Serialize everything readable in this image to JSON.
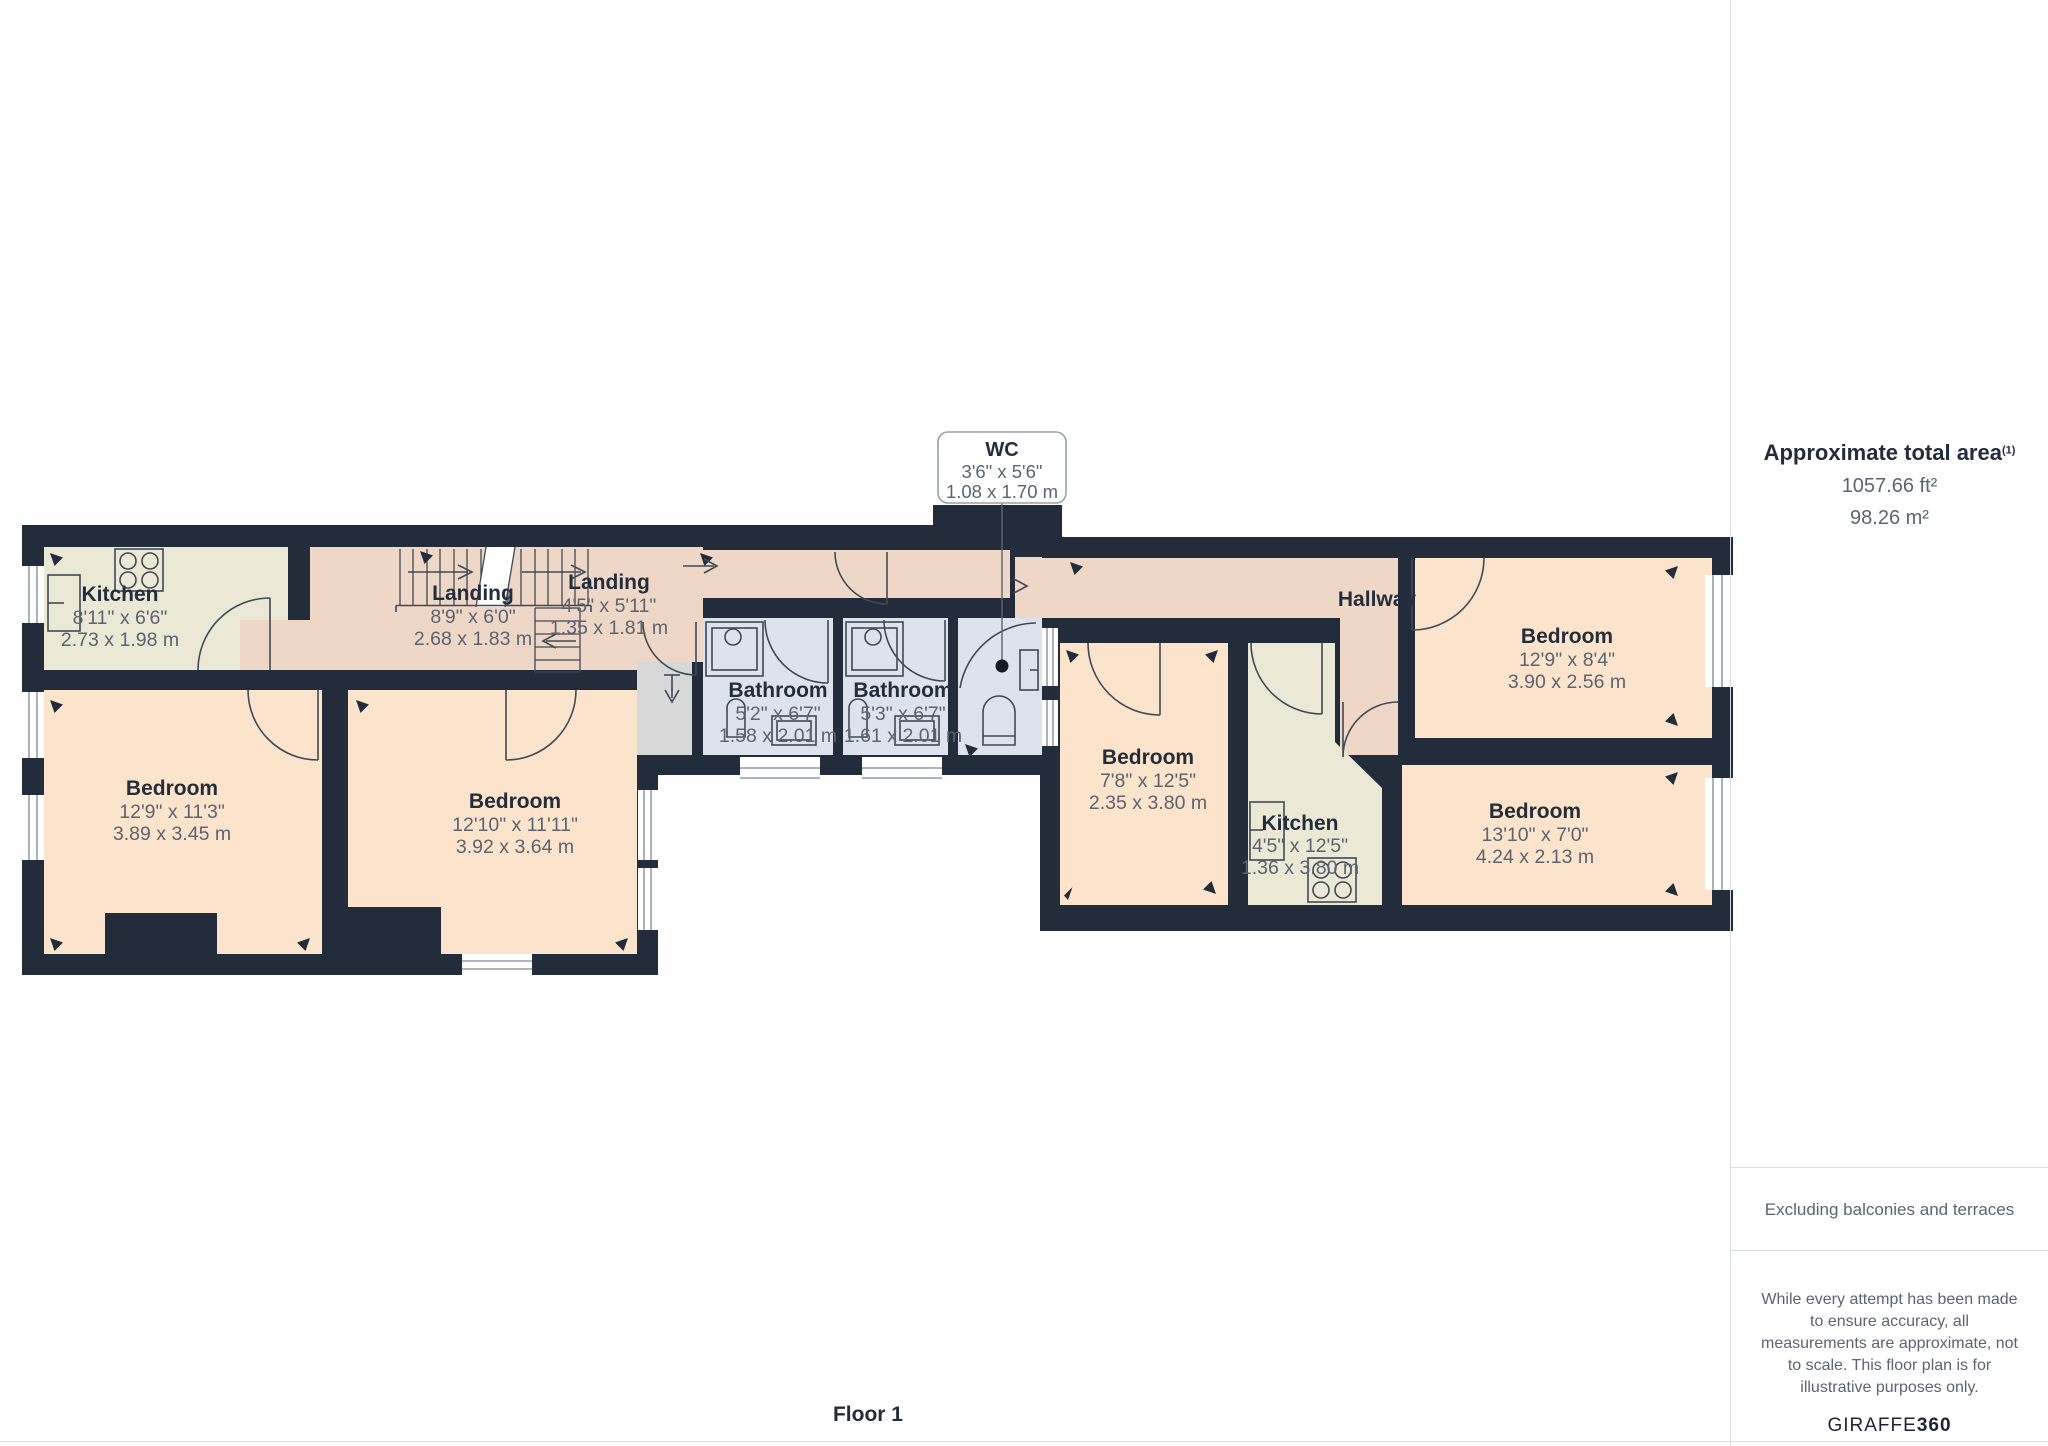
{
  "plan": {
    "rooms": [
      {
        "name": "Kitchen",
        "imperial": "8'11\" x 6'6\"",
        "metric": "2.73 x 1.98 m"
      },
      {
        "name": "Landing",
        "imperial": "8'9\" x 6'0\"",
        "metric": "2.68 x 1.83 m"
      },
      {
        "name": "Landing",
        "imperial": "4'5\" x 5'11\"",
        "metric": "1.35 x 1.81 m"
      },
      {
        "name": "Bathroom",
        "imperial": "5'2\" x 6'7\"",
        "metric": "1.58 x 2.01 m"
      },
      {
        "name": "Bathroom",
        "imperial": "5'3\" x 6'7\"",
        "metric": "1.61 x 2.01 m"
      },
      {
        "name": "Bedroom",
        "imperial": "12'9\" x 11'3\"",
        "metric": "3.89 x 3.45 m"
      },
      {
        "name": "Bedroom",
        "imperial": "12'10\" x 11'11\"",
        "metric": "3.92 x 3.64 m"
      },
      {
        "name": "Bedroom",
        "imperial": "7'8\" x 12'5\"",
        "metric": "2.35 x 3.80 m"
      },
      {
        "name": "Kitchen",
        "imperial": "4'5\" x 12'5\"",
        "metric": "1.36 x 3.80 m"
      },
      {
        "name": "Bedroom",
        "imperial": "12'9\" x 8'4\"",
        "metric": "3.90 x 2.56 m"
      },
      {
        "name": "Bedroom",
        "imperial": "13'10\" x 7'0\"",
        "metric": "4.24 x 2.13 m"
      },
      {
        "name": "Hallway"
      }
    ],
    "wc_callout": {
      "name": "WC",
      "imperial": "3'6\" x 5'6\"",
      "metric": "1.08 x 1.70 m"
    },
    "floor_label": "Floor 1"
  },
  "sidebar": {
    "area_title": "Approximate total area",
    "area_superscript": "(1)",
    "area_ft": "1057.66 ft²",
    "area_m": "98.26 m²",
    "excluding": "Excluding balconies and terraces",
    "disclaimer": "While every attempt has been made to ensure accuracy, all measurements are approximate, not to scale. This floor plan is for illustrative purposes only.",
    "brand_regular": "GIRAFFE",
    "brand_bold": "360"
  },
  "colors": {
    "wall": "#222c3a",
    "bedroom": "#fce4cc",
    "landing": "#efd7c7",
    "kitchen": "#ebe8d6",
    "bath": "#dde3ed",
    "shaft": "#d8d8d8",
    "line": "#3f4a56",
    "name": "#232d3b",
    "dim": "#5b6470",
    "border": "#d9dde1"
  }
}
